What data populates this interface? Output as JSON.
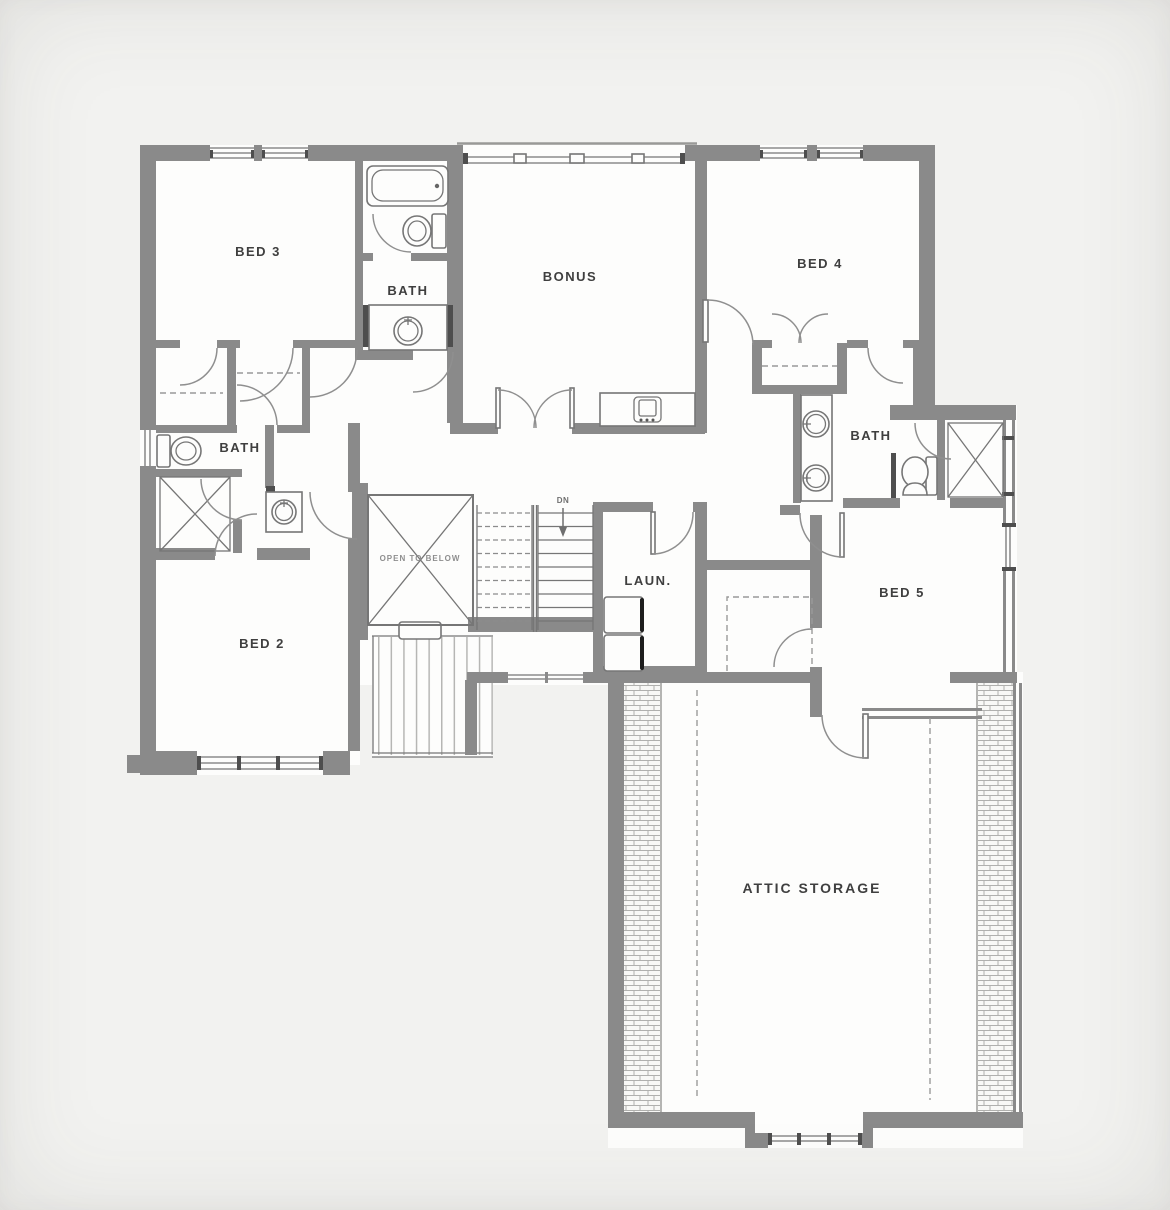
{
  "colors": {
    "bg": "#f2f2f0",
    "paper": "#fdfdfc",
    "wall": "#8a8a8a",
    "wall-dark": "#4e4e4e",
    "line": "#767676",
    "line-light": "#adadad",
    "text": "#3f3f3f",
    "text-light": "#8e8e8e"
  },
  "rooms": {
    "bed3": "BED 3",
    "bath_top": "BATH",
    "bonus": "BONUS",
    "bed4": "BED 4",
    "bath_left": "BATH",
    "bath_right": "BATH",
    "bed2": "BED 2",
    "bed5": "BED 5",
    "laundry": "LAUN.",
    "attic": "ATTIC STORAGE"
  },
  "annotations": {
    "open_to_below": "OPEN TO BELOW",
    "stair_direction": "DN"
  }
}
